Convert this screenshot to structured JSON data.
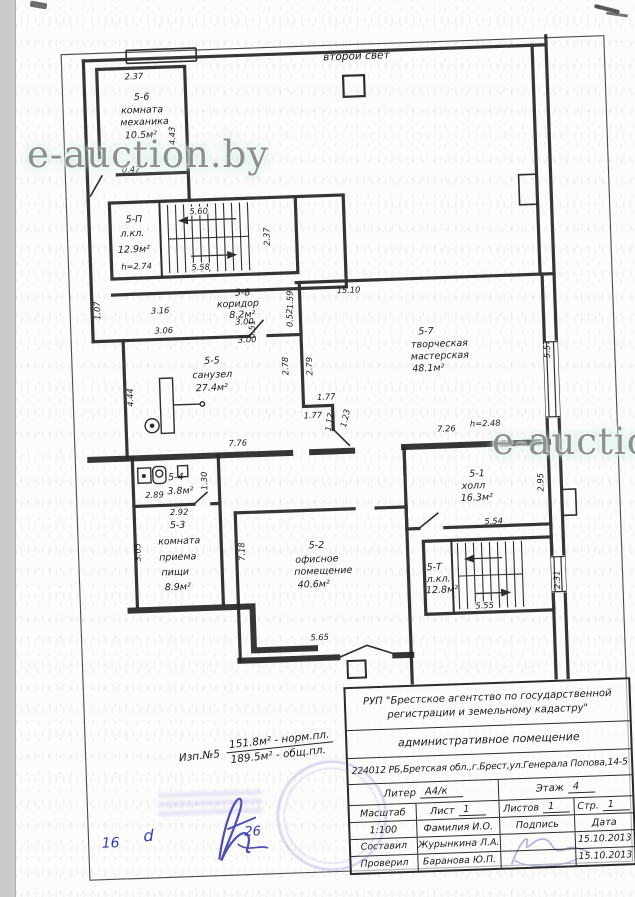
{
  "watermark": {
    "text": "e-auction.by"
  },
  "plan": {
    "upper_label": "второй свет",
    "rooms": {
      "r56": {
        "id": "5-6",
        "line1": "комната",
        "line2": "механика",
        "area": "10.5м²"
      },
      "r5p": {
        "id": "5-П",
        "line1": "л.кл.",
        "area": "12.9м²"
      },
      "r58": {
        "id": "5-8",
        "line1": "коридор",
        "area": "8.2м²"
      },
      "r55": {
        "id": "5-5",
        "line1": "санузел",
        "area": "27.4м²"
      },
      "r57": {
        "id": "5-7",
        "line1": "творческая",
        "line2": "мастерская",
        "area": "48.1м²"
      },
      "r51": {
        "id": "5-1",
        "line1": "холл",
        "area": "16.3м²"
      },
      "r54": {
        "id": "5-4",
        "area": "3.8м²"
      },
      "r53": {
        "id": "5-3",
        "line1": "комната",
        "line2": "приема",
        "line3": "пищи",
        "area": "8.9м²"
      },
      "r52": {
        "id": "5-2",
        "line1": "офисное",
        "line2": "помещение",
        "area": "40.6м²"
      },
      "r5t": {
        "id": "5-Т",
        "line1": "л.кл.",
        "area": "12.8м²"
      }
    },
    "dims": {
      "d237": "2.37",
      "d443": "4.43",
      "d047": "0.47",
      "d560": "5.60",
      "d558": "5.58",
      "h274": "h=2.74",
      "d107": "1.07",
      "d316": "3.16",
      "d306": "3.06",
      "d051": "0.51",
      "d052": "0.52",
      "d300": "3.00",
      "d159": "1.59",
      "d1510": "15.10",
      "d278": "2.78",
      "d279": "2.79",
      "d177": "1.77",
      "d112": "1.12",
      "d123": "1.23",
      "d444": "4.44",
      "d776": "7.76",
      "d726": "7.26",
      "h248": "h=2.48",
      "d557": "5.57",
      "d295": "2.95",
      "d554": "5.54",
      "d231": "2.31",
      "d555": "5.55",
      "d289": "2.89",
      "d130": "1.30",
      "d292": "2.92",
      "d305": "3.05",
      "d718": "7.18",
      "d565": "5.65"
    }
  },
  "note": {
    "label": "Изп.№5",
    "top": "151.8м² - норм.пл.",
    "bottom": "189.5м² - общ.пл."
  },
  "handwriting": {
    "h1": "16",
    "h2": "d",
    "h3": "26"
  },
  "title_block": {
    "org_line1": "РУП \"Брестское агентство по государственной",
    "org_line2": "регистрации и земельному кадастру\"",
    "object": "административное помещение",
    "address": "224012 РБ,Бретская обл.,г.Брест,ул.Генерала Попова,14-5",
    "liter_label": "Литер",
    "liter_value": "А4/к",
    "floor_label": "Этаж",
    "floor_value": "4",
    "scale_label": "Масштаб",
    "scale_value": "1:100",
    "sheet_label": "Лист",
    "sheet_value": "1",
    "sheets_label": "Листов",
    "sheets_value": "1",
    "page_label": "Стр.",
    "page_value": "1",
    "name_col": "Фамилия И.О.",
    "sign_col": "Подпись",
    "date_col": "Дата",
    "composed_label": "Составил",
    "composed_name": "Журынкина Л.А.",
    "composed_date": "15.10.2013",
    "checked_label": "Проверил",
    "checked_name": "Баранова Ю.П.",
    "checked_date": "15.10.2013"
  }
}
